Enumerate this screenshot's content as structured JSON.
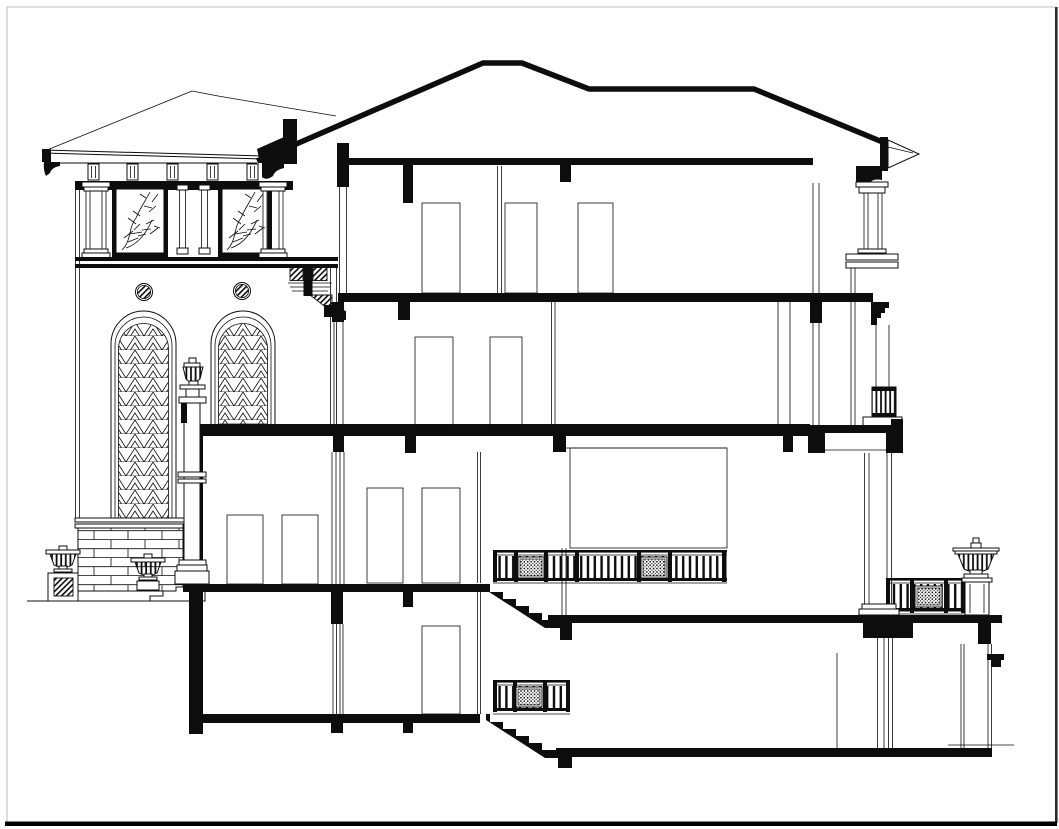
{
  "drawing": {
    "description": "Architectural CAD section and partial elevation of a multi-storey villa: left tower elevation with hip roof, foliage frieze panels, round medallions and arched lattice windows; central building cut in section with black floor slabs, door openings, two stair flights with ornamental balustrades; right loggia column stack, balcony railing with urn, and foundation",
    "view_type": "building-cross-section",
    "storeys_visible": 4
  },
  "colors": {
    "ink": "#0d0d0d",
    "paper": "#ffffff",
    "frame_light": "#c9c9c9",
    "frame_dark": "#2b2b2b",
    "border_bottom": "#000000"
  },
  "legend": {
    "tower_roof": "hip roof with fascia and eave brackets",
    "frieze": "triglyph blocks over foliage-ornament window panels",
    "tower_columns": "classical columns and paired pilasters",
    "medallions": "two hatched circular medallions",
    "arched_windows": "two round-arched windows with triangular lattice glazing",
    "central_pedestal": "urn finial on tall pedestal between windows",
    "brick_base": "coursed brick parapet wall with entry steps and planter urns",
    "main_roof": "main hipped roof profile with right eave and cornice bracket",
    "floor_slabs": "ceiling, third, second, ground, terrace, basement and lower slabs in black section",
    "doors": "door openings on every storey",
    "stairs": "two black stepped stair flights between split levels",
    "balustrades": "three railings with balusters and filigree panels",
    "right_loggia": "two-storey column stack with capitals, corbel and balcony beam",
    "right_balcony": "terrace railing with fluted urn on pedestal",
    "sheet_frame": "drawing sheet border lines"
  }
}
